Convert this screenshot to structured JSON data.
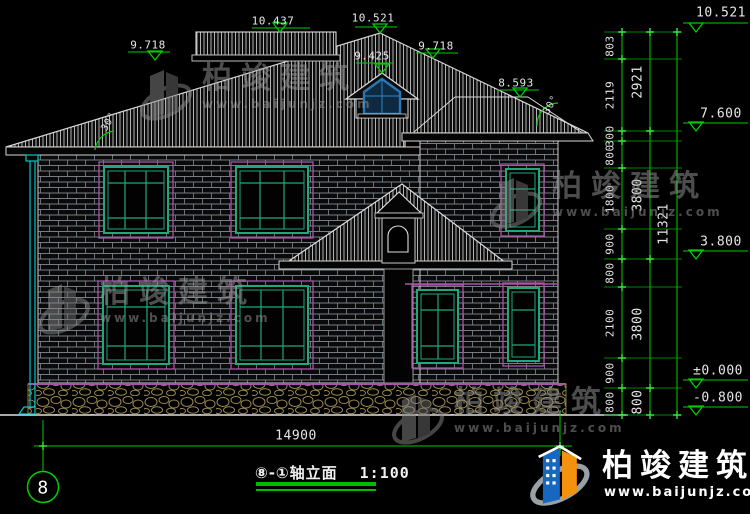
{
  "drawing": {
    "axis_bubble": "8",
    "title": "⑧-①轴立面",
    "scale_label": "1:100",
    "overall_width": "14900",
    "total_height": "11321",
    "angle_left": "30°",
    "angle_right": "30°",
    "roof_elevations": {
      "deck": "10.437",
      "ridge": "10.521",
      "left_slope": "9.718",
      "dormer": "9.425",
      "right_slope": "9.718",
      "wing_ridge": "8.593"
    },
    "level_elevations": {
      "top": "10.521",
      "eave": "7.600",
      "floor2": "3.800",
      "ground": "±0.000",
      "foundation": "-0.800"
    },
    "chain_inner": [
      "803",
      "2119",
      "300",
      "800",
      "1800",
      "900",
      "800",
      "2100",
      "900",
      "800"
    ],
    "chain_middle": [
      "2921",
      "3800",
      "3800",
      "800"
    ]
  },
  "watermark": {
    "name": "柏竣建筑",
    "url": "www.baijunjz.com"
  },
  "brand": {
    "name": "柏竣建筑",
    "url": "www.baijunjz.com"
  },
  "colors": {
    "dimension_green": "#00cc00",
    "window_green": "#1fa87c",
    "trim_magenta": "#a855a8",
    "downspout_cyan": "#00c8cc",
    "stone_tan": "#98884e",
    "dormer_blue": "#2778b5",
    "logo_blue": "#1766c0",
    "logo_orange": "#f2920f"
  }
}
